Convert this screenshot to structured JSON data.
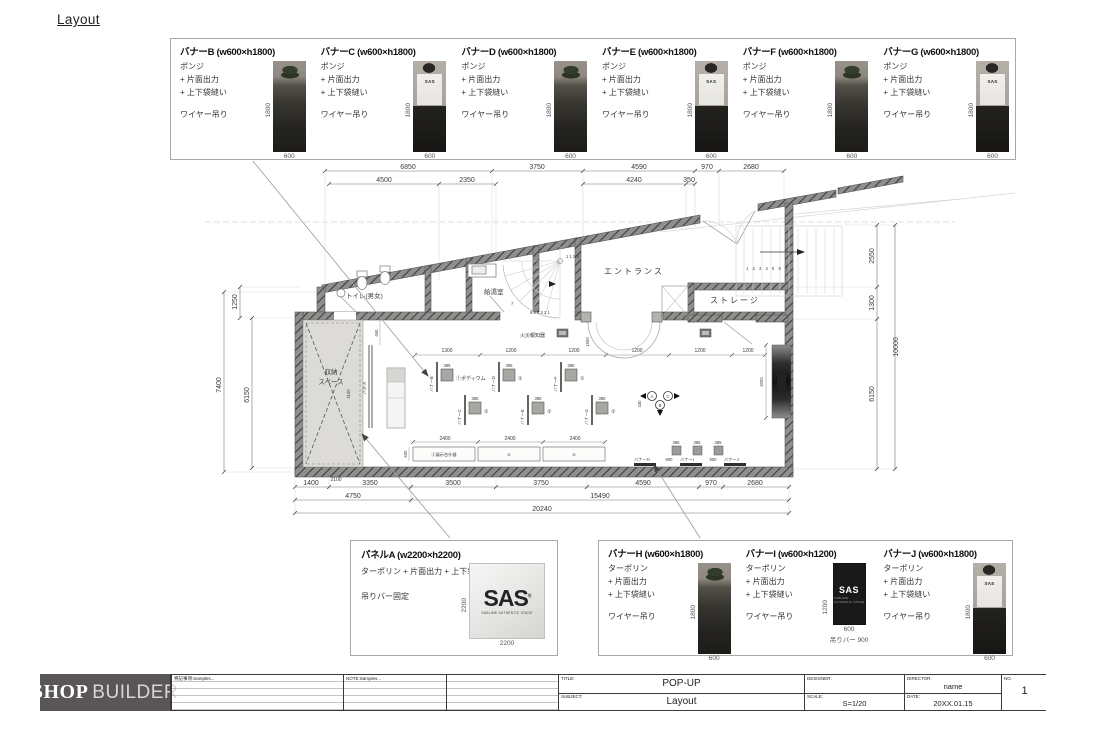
{
  "page": {
    "title": "Layout"
  },
  "photos": {
    "shirt_logo": "SAS",
    "banner_logo": "SAS",
    "banner_sub": "SUBLIME AUTHENTIC STAGE"
  },
  "top_banners": {
    "items": [
      {
        "title": "バナーB (w600×h1800)",
        "material": "ポンジ",
        "opt1": "+ 片面出力",
        "opt2": "+ 上下袋縫い",
        "hang": "ワイヤー吊り",
        "h": "1800",
        "w": "600"
      },
      {
        "title": "バナーC (w600×h1800)",
        "material": "ポンジ",
        "opt1": "+ 片面出力",
        "opt2": "+ 上下袋縫い",
        "hang": "ワイヤー吊り",
        "h": "1800",
        "w": "600"
      },
      {
        "title": "バナーD (w600×h1800)",
        "material": "ポンジ",
        "opt1": "+ 片面出力",
        "opt2": "+ 上下袋縫い",
        "hang": "ワイヤー吊り",
        "h": "1800",
        "w": "600"
      },
      {
        "title": "バナーE (w600×h1800)",
        "material": "ポンジ",
        "opt1": "+ 片面出力",
        "opt2": "+ 上下袋縫い",
        "hang": "ワイヤー吊り",
        "h": "1800",
        "w": "600"
      },
      {
        "title": "バナーF (w600×h1800)",
        "material": "ポンジ",
        "opt1": "+ 片面出力",
        "opt2": "+ 上下袋縫い",
        "hang": "ワイヤー吊り",
        "h": "1800",
        "w": "600"
      },
      {
        "title": "バナーG (w600×h1800)",
        "material": "ポンジ",
        "opt1": "+ 片面出力",
        "opt2": "+ 上下袋縫い",
        "hang": "ワイヤー吊り",
        "h": "1800",
        "w": "600"
      }
    ]
  },
  "bottom_banners": {
    "items": [
      {
        "title": "バナーH (w600×h1800)",
        "material": "ターポリン",
        "opt1": "+ 片面出力",
        "opt2": "+ 上下袋縫い",
        "hang": "ワイヤー吊り",
        "h": "1800",
        "w": "600"
      },
      {
        "title": "バナーI (w600×h1200)",
        "material": "ターポリン",
        "opt1": "+ 片面出力",
        "opt2": "+ 上下袋縫い",
        "hang": "ワイヤー吊り",
        "h": "1200",
        "w": "600",
        "extra": "吊りバー 900"
      },
      {
        "title": "バナーJ (w600×h1800)",
        "material": "ターポリン",
        "opt1": "+ 片面出力",
        "opt2": "+ 上下袋縫い",
        "hang": "ワイヤー吊り",
        "h": "1800",
        "w": "600"
      }
    ]
  },
  "panel_a": {
    "title": "パネルA (w2200×h2200)",
    "materials": "ターポリン + 片面出力 + 上下袋縫い",
    "hang": "吊りバー固定",
    "h": "2200",
    "w": "2200",
    "logo": "SAS",
    "reg": "®",
    "logo_sub": "SUBLIME AUTHENTIC STAGE"
  },
  "plan": {
    "top1": [
      "6850",
      "3750",
      "4590",
      "970",
      "2680"
    ],
    "top2": [
      "4500",
      "2350",
      "4240",
      "350"
    ],
    "bot1": [
      "1400",
      "3350",
      "3500",
      "3750",
      "4590",
      "970",
      "2680"
    ],
    "bot2": [
      "4750",
      "15490"
    ],
    "bot3": "20240",
    "left": [
      "1250",
      "7400",
      "6150"
    ],
    "right": [
      "2550",
      "1300",
      "10000",
      "6150"
    ],
    "shelf": [
      "1300",
      "1200",
      "1200",
      "1200",
      "1200",
      "1200"
    ],
    "tables": [
      "2400",
      "2400",
      "2400"
    ],
    "rooms": {
      "toilet": "トイレ(男女)",
      "kitchen": "給湯室",
      "entrance": "エントランス",
      "storage": "ストレージ",
      "storage_space1": "収納",
      "storage_space2": "スペース",
      "fire_alarm": "火災報知器"
    },
    "fix": {
      "podium": "①ポディウム",
      "one": "①",
      "table1": "②展示台什器",
      "two": "②",
      "panel": "パネ-A"
    },
    "marks": {
      "h": "バナーH",
      "i": "バナーI",
      "j": "バナーJ",
      "gap": "900",
      "dim": "385"
    },
    "stairs": {
      "main": "1 2 3 4 5 6 7",
      "sp_top": "1 1 2 3",
      "sp_bot": "6 5 4 3 2 1",
      "seven": "7"
    },
    "small": {
      "a2100": "2100",
      "b2100": "2100",
      "d650": "650",
      "d600": "600",
      "d1500": "1500",
      "d4000": "4000",
      "d430": "430"
    },
    "view": {
      "a": "A",
      "b": "B",
      "c": "C"
    },
    "cols": {
      "b": "バナーB",
      "c": "バナーC",
      "d": "バナーD",
      "e": "バナーE",
      "f": "バナーF",
      "g": "バナーG"
    }
  },
  "titleblock": {
    "logo_shop": "SHOP",
    "logo_builder": "BUILDER",
    "notes": "特記事項:Samples...",
    "note": "NOTE:Samples...",
    "title_label": "TITLE:",
    "title": "POP-UP",
    "subject_label": "SUBJECT:",
    "subject": "Layout",
    "designer_label": "DESIGNER:",
    "scale_label": "SCALE:",
    "scale": "S=1/20",
    "director_label": "DIRECTOR:",
    "director": "name",
    "date_label": "DATE:",
    "date": "20XX.01.15",
    "no_label": "NO.",
    "no": "1"
  }
}
